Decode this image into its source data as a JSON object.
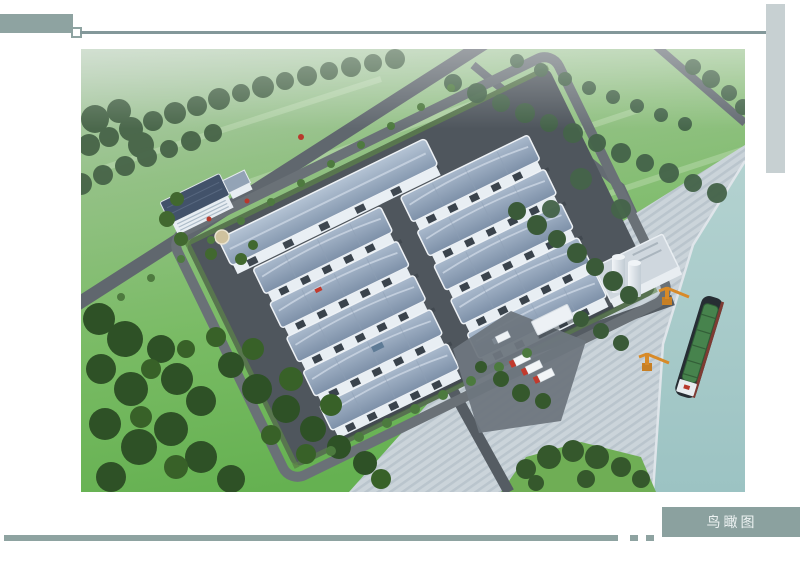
{
  "caption": {
    "label": "鸟瞰图"
  },
  "theme": {
    "page_bg": "#ffffff",
    "accent": "#8ea3a1",
    "accent_line": "#83989a",
    "bar_light": "#c7d0d2",
    "caption_bg": "#8ba19f",
    "caption_text": "#edf2f2"
  },
  "scene": {
    "name": "industrial-park-aerial-rendering",
    "palette": {
      "grass_top": "#b7cdb6",
      "grass_bottom": "#65b151",
      "forest": "#31512a",
      "road": "#60676e",
      "site_pavement": "#4f565d",
      "warehouse_roof": "#8496ad",
      "warehouse_wall": "#e9eff4",
      "office_roof": "#42526a",
      "wharf": "#cbd4da",
      "water": "#a4c8c6",
      "crane": "#d88a28",
      "ship_deck": "#47834d",
      "truck_red": "#c23a2d"
    }
  }
}
